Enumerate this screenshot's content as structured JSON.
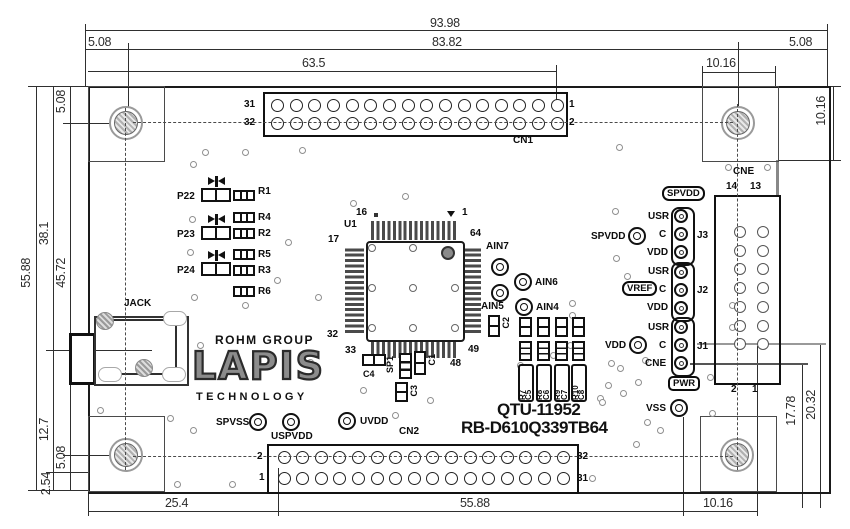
{
  "board": {
    "logo": {
      "rohm": "ROHM GROUP",
      "lapis": "LAPIS",
      "technology": "TECHNOLOGY"
    },
    "part_numbers": {
      "line1": "QTU-11952",
      "line2": "RB-D610Q339TB64"
    },
    "jack_label": "JACK",
    "chip": {
      "ref": "U1",
      "pin_top_left": "16",
      "pin_top_right": "1",
      "pin_left_top": "17",
      "pin_left_bottom": "32",
      "pin_bottom_left": "33",
      "pin_bottom_right": "48",
      "pin_right_bottom": "49",
      "pin_right_top": "64"
    },
    "cn1": {
      "name": "CN1",
      "row1_left": "31",
      "row2_left": "32",
      "row1_right": "1",
      "row2_right": "2",
      "pins_per_row": 16
    },
    "cn2": {
      "name": "CN2",
      "row1_left": "2",
      "row2_left": "1",
      "row1_right": "32",
      "row2_right": "31",
      "pins_per_row": 16
    },
    "cne": {
      "name": "CNE",
      "top_left": "14",
      "top_right": "13",
      "bottom_left": "2",
      "bottom_right": "1",
      "rows": 7
    },
    "headers": {
      "j3": {
        "name": "J3",
        "pin1": "USR",
        "pin2": "C",
        "pin3": "VDD",
        "pad_label": "SPVDD",
        "box_label": "SPVDD"
      },
      "j2": {
        "name": "J2",
        "pin1": "USR",
        "pin2": "C",
        "pin3": "VDD",
        "box_label": "VREF"
      },
      "j1": {
        "name": "J1",
        "pin1": "USR",
        "pin2": "C",
        "pin3": "CNE",
        "pad_label": "VDD",
        "box_label": "PWR"
      }
    },
    "vss_label": "VSS",
    "power_pads": {
      "spvss": "SPVSS",
      "uspvdd": "USPVDD",
      "uvdd": "UVDD"
    },
    "analog_pads": {
      "ain7": "AIN7",
      "ain6": "AIN6",
      "ain5": "AIN5",
      "ain4": "AIN4"
    },
    "led_labels": [
      "P22",
      "P23",
      "P24"
    ],
    "resistor_labels": [
      "R1",
      "R4",
      "R2",
      "R5",
      "R3",
      "R6"
    ],
    "rc_boxes": [
      {
        "r": "R7",
        "c": "C5"
      },
      {
        "r": "R8",
        "c": "C6"
      },
      {
        "r": "R9",
        "c": "C7"
      },
      {
        "r": "R10",
        "c": "C8"
      }
    ],
    "small_parts": {
      "c4": "C4",
      "sp1": "SP1",
      "c1": "C1",
      "c3": "C3",
      "c2": "C2"
    }
  },
  "dimensions": {
    "top": {
      "total": "93.98",
      "inner": "83.82",
      "left_offset": "5.08",
      "right_offset": "5.08",
      "cn1": "63.5",
      "hole": "10.16"
    },
    "right": {
      "hole_vert": "10.16",
      "v1": "17.78",
      "v2": "20.32"
    },
    "left": {
      "total": "55.88",
      "seg1": "38.1",
      "seg2": "12.7",
      "seg3": "2.54",
      "in_top": "5.08",
      "in_mid": "45.72",
      "in_bot": "5.08"
    },
    "bottom": {
      "left": "25.4",
      "mid": "55.88",
      "right": "10.16"
    }
  },
  "vias": [
    [
      205,
      152
    ],
    [
      245,
      152
    ],
    [
      302,
      150
    ],
    [
      193,
      164
    ],
    [
      405,
      196
    ],
    [
      619,
      147
    ],
    [
      728,
      167
    ],
    [
      767,
      167
    ],
    [
      192,
      219
    ],
    [
      288,
      242
    ],
    [
      353,
      203
    ],
    [
      318,
      297
    ],
    [
      277,
      280
    ],
    [
      190,
      252
    ],
    [
      194,
      297
    ],
    [
      245,
      305
    ],
    [
      200,
      345
    ],
    [
      310,
      362
    ],
    [
      100,
      410
    ],
    [
      170,
      418
    ],
    [
      193,
      430
    ],
    [
      177,
      484
    ],
    [
      232,
      484
    ],
    [
      363,
      390
    ],
    [
      395,
      415
    ],
    [
      430,
      400
    ],
    [
      520,
      365
    ],
    [
      545,
      385
    ],
    [
      553,
      355
    ],
    [
      570,
      345
    ],
    [
      600,
      398
    ],
    [
      660,
      430
    ],
    [
      636,
      444
    ],
    [
      592,
      478
    ],
    [
      615,
      211
    ],
    [
      616,
      258
    ],
    [
      627,
      276
    ],
    [
      572,
      303
    ],
    [
      572,
      315
    ],
    [
      611,
      363
    ],
    [
      620,
      368
    ],
    [
      608,
      385
    ],
    [
      623,
      393
    ],
    [
      602,
      402
    ],
    [
      638,
      382
    ],
    [
      645,
      360
    ],
    [
      647,
      422
    ],
    [
      712,
      413
    ],
    [
      710,
      377
    ],
    [
      732,
      305
    ],
    [
      732,
      327
    ]
  ]
}
